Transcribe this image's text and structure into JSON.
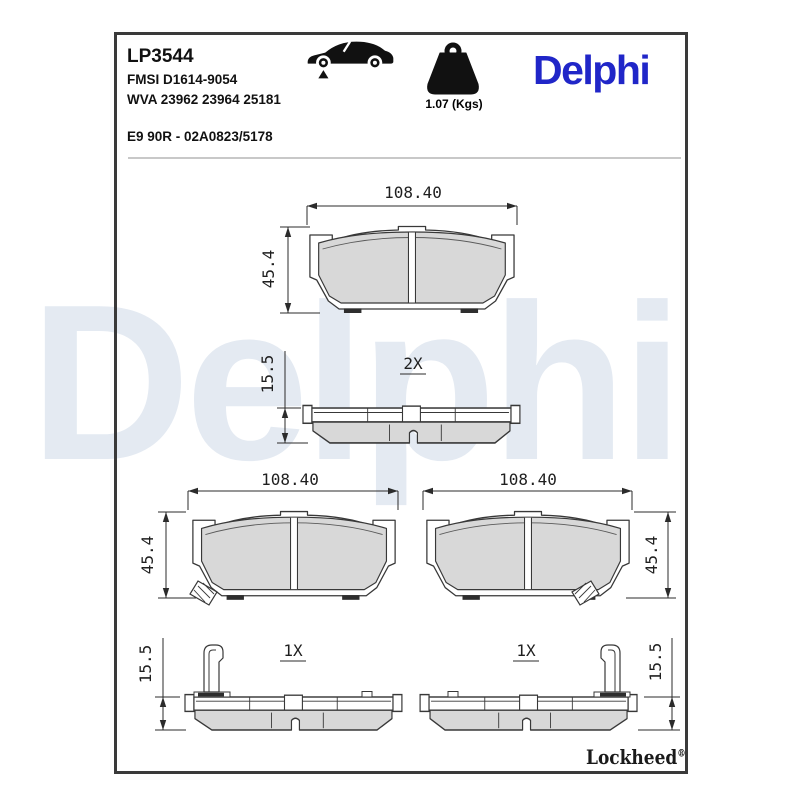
{
  "header": {
    "part_number": "LP3544",
    "fmsi_reference": "FMSI D1614-9054",
    "wva_reference": "WVA 23962 23964 25181",
    "homologation": "E9 90R - 02A0823/5178",
    "weight_label": "1.07 (Kgs)",
    "brand_logo_text": "Delphi"
  },
  "icons": {
    "vehicle_icon": "car-side-silhouette-with-front-axle-marker",
    "weight_icon": "kettlebell-weight"
  },
  "watermark_text": "Delphi",
  "drawings": {
    "top_front_view": {
      "width_dim": "108.40",
      "height_dim": "45.4"
    },
    "top_side_view": {
      "thickness_dim": "15.5",
      "quantity": "2X"
    },
    "left_front_view": {
      "width_dim": "108.40",
      "height_dim": "45.4"
    },
    "right_front_view": {
      "width_dim": "108.40",
      "height_dim": "45.4"
    },
    "left_side_view": {
      "thickness_dim": "15.5",
      "quantity": "1X"
    },
    "right_side_view": {
      "thickness_dim": "15.5",
      "quantity": "1X"
    }
  },
  "footer": {
    "lockheed_label": "Lockheed",
    "registered_mark": "®"
  },
  "colors": {
    "brand_blue": "#2026c8",
    "watermark_blue": "#e4eaf2",
    "pad_fill": "#d8d8d8",
    "drawing_line": "#383838",
    "frame_border": "#3a3a3a"
  }
}
